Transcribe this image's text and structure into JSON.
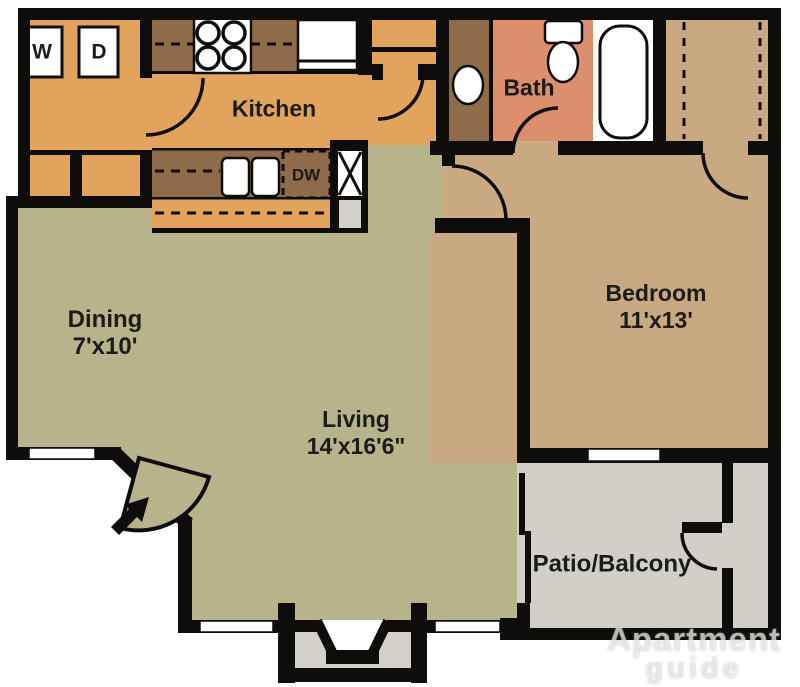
{
  "colors": {
    "wall": "#0e0d0b",
    "kitchen_floor": "#e2a45c",
    "counter_brown": "#8e6c49",
    "living_floor": "#b7b48c",
    "bedroom_floor": "#c9a981",
    "bath_floor": "#db8f6d",
    "patio_floor": "#d2cfc9",
    "hearth_gray": "#d4d0ca",
    "fixture_white": "#ffffff"
  },
  "rooms": {
    "kitchen": {
      "label": "Kitchen"
    },
    "bath": {
      "label": "Bath"
    },
    "dining": {
      "label": "Dining",
      "dimensions": "7'x10'"
    },
    "living": {
      "label": "Living",
      "dimensions": "14'x16'6\""
    },
    "bedroom": {
      "label": "Bedroom",
      "dimensions": "11'x13'"
    },
    "patio": {
      "label": "Patio/Balcony"
    }
  },
  "appliances": {
    "washer": "W",
    "dryer": "D",
    "dishwasher": "DW"
  },
  "watermark": {
    "line1": "Apartment",
    "line2": "guide"
  }
}
